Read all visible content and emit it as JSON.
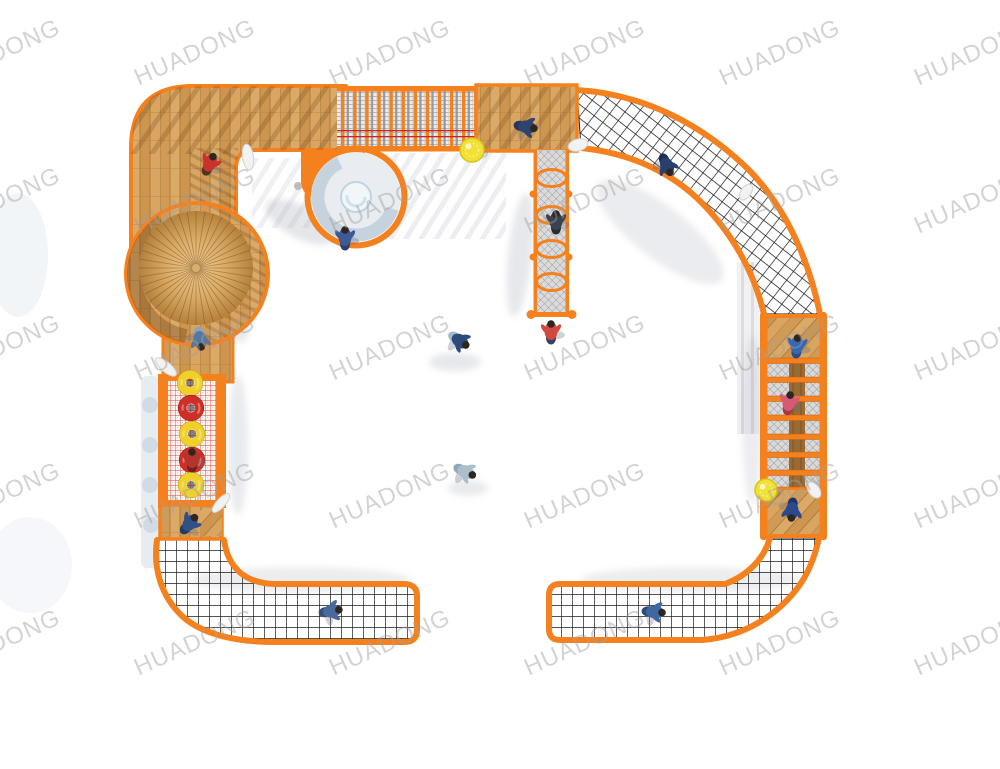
{
  "scene": {
    "description": "Top-down 3D product render of an outdoor children's rope-climbing playground forming an open rectangular loop on a white ground",
    "canvas": {
      "width": 1000,
      "height": 769
    }
  },
  "watermark": {
    "text": "HUADONG",
    "font_size": 24,
    "rotation_deg": -24,
    "color": "#a0a0a0",
    "opacity": 0.45,
    "grid": {
      "start_x": -132,
      "start_y": 53,
      "step_x": 195,
      "step_y": 147.5,
      "cols": 7,
      "rows": 5
    }
  },
  "palette": {
    "ground": "#ffffff",
    "orange": "#f5811e",
    "orange_dark": "#d4650a",
    "wood": "#d7a25e",
    "wood_dark": "#a9763c",
    "wood_beam": "#9a6a35",
    "net_black": "#1b1b1b",
    "mesh_grey": "#969696",
    "mesh_bg": "#d9d9d9",
    "bridge_bg": "#ececec",
    "red_frame": "#e04338",
    "red_line": "#cc2520",
    "ring_yellow": "#f0d02a",
    "ring_red": "#cf2f27",
    "ball_yellow": "#f2e135",
    "slide_white": "#e9edf1",
    "slide_shade": "#aabccd",
    "shadow": "rgba(120,130,150,0.20)",
    "ghost": "rgba(190,205,220,0.45)",
    "white_prop": "#f2f2f2"
  },
  "components": [
    "top-left-wood-deck",
    "spiral-tube-slide",
    "round-roof-platform",
    "vertical-post-net-bridge",
    "top-wood-deck",
    "crawl-net-tunnel",
    "corner-climb-net-top-right",
    "right-wood-deck-upper",
    "right-rung-ladder-wall",
    "right-wood-deck-lower",
    "flat-climb-net-bottom-right",
    "flat-climb-net-bottom-left",
    "bottom-left-wood-deck",
    "ring-climb-wall",
    "left-wood-deck"
  ],
  "rings": [
    {
      "x": 190,
      "y": 383,
      "color": "#f0d02a",
      "edge": "#c8a513"
    },
    {
      "x": 191,
      "y": 408,
      "color": "#cf2f27",
      "edge": "#981f19"
    },
    {
      "x": 192,
      "y": 434,
      "color": "#f0d02a",
      "edge": "#c8a513"
    },
    {
      "x": 192,
      "y": 460,
      "color": "#cf2f27",
      "edge": "#981f19"
    },
    {
      "x": 191,
      "y": 485,
      "color": "#f0d02a",
      "edge": "#c8a513"
    }
  ],
  "balls": [
    {
      "x": 472,
      "y": 150,
      "r": 12
    },
    {
      "x": 766,
      "y": 490,
      "r": 11
    }
  ],
  "props": [
    {
      "name": "rocket-toy",
      "x": 248,
      "y": 157,
      "rot": -8,
      "rx": 5.5,
      "ry": 13
    },
    {
      "name": "periscope-toy",
      "x": 166,
      "y": 367,
      "rot": -50,
      "rx": 5,
      "ry": 13
    },
    {
      "name": "periscope-toy",
      "x": 221,
      "y": 503,
      "rot": 42,
      "rx": 4.5,
      "ry": 12
    },
    {
      "name": "mushroom-knob",
      "x": 746,
      "y": 192,
      "rot": 35,
      "rx": 5,
      "ry": 9
    },
    {
      "name": "net-connector",
      "x": 578,
      "y": 145,
      "rot": -15,
      "rx": 10,
      "ry": 6
    },
    {
      "name": "net-connector",
      "x": 814,
      "y": 490,
      "rot": 55,
      "rx": 9,
      "ry": 5.5
    }
  ],
  "figures": [
    {
      "part": "deck-top-left",
      "x": 210,
      "y": 163,
      "rot": 25,
      "shirt": "#c8342c",
      "pants": "#4a3527"
    },
    {
      "part": "slide-exit",
      "x": 345,
      "y": 237,
      "rot": 0,
      "shirt": "#3c5a96",
      "pants": "#2e3f6e"
    },
    {
      "part": "deck-top",
      "x": 527,
      "y": 127,
      "rot": 100,
      "shirt": "#2e4470",
      "pants": "#27355c"
    },
    {
      "part": "net-top-right",
      "x": 667,
      "y": 166,
      "rot": 155,
      "shirt": "#27406e",
      "pants": "#1d2f52"
    },
    {
      "part": "crawl-tunnel",
      "x": 556,
      "y": 221,
      "rot": 0,
      "shirt": "#3a4250",
      "pants": "#262b33"
    },
    {
      "part": "below-tunnel",
      "x": 551,
      "y": 331,
      "rot": 0,
      "shirt": "#d04a3e",
      "pants": "#39406b"
    },
    {
      "part": "ground-center",
      "x": 460,
      "y": 341,
      "rot": 125,
      "shirt": "#2c4a7c",
      "pants": "#a3b8cc"
    },
    {
      "part": "ground-lower",
      "x": 466,
      "y": 472,
      "rot": 115,
      "shirt": "#aabecb",
      "pants": "#90a7b9"
    },
    {
      "part": "deck-right-upper",
      "x": 797,
      "y": 345,
      "rot": 5,
      "shirt": "#3468b0",
      "pants": "#274f86"
    },
    {
      "part": "ladder-right",
      "x": 789,
      "y": 402,
      "rot": 10,
      "shirt": "#d65a74",
      "pants": "#a83648"
    },
    {
      "part": "deck-bottom-right",
      "x": 792,
      "y": 511,
      "rot": 185,
      "shirt": "#2b4a8c",
      "pants": "#1d3566"
    },
    {
      "part": "net-bottom-right",
      "x": 655,
      "y": 612,
      "rot": 95,
      "shirt": "#3f68a0",
      "pants": "#2c4a78"
    },
    {
      "part": "net-bottom-left",
      "x": 332,
      "y": 611,
      "rot": 80,
      "shirt": "#4a6a9a",
      "pants": "#33507a"
    },
    {
      "part": "deck-bottom-left",
      "x": 190,
      "y": 523,
      "rot": 40,
      "shirt": "#2f5188",
      "pants": "#223c66"
    },
    {
      "part": "ring-wall",
      "x": 192,
      "y": 459,
      "rot": 0,
      "shirt": "#b5342c",
      "pants": "#741f19"
    },
    {
      "part": "deck-left",
      "x": 200,
      "y": 340,
      "rot": 170,
      "shirt": "#56779f",
      "pants": "#8fa3b5"
    }
  ]
}
